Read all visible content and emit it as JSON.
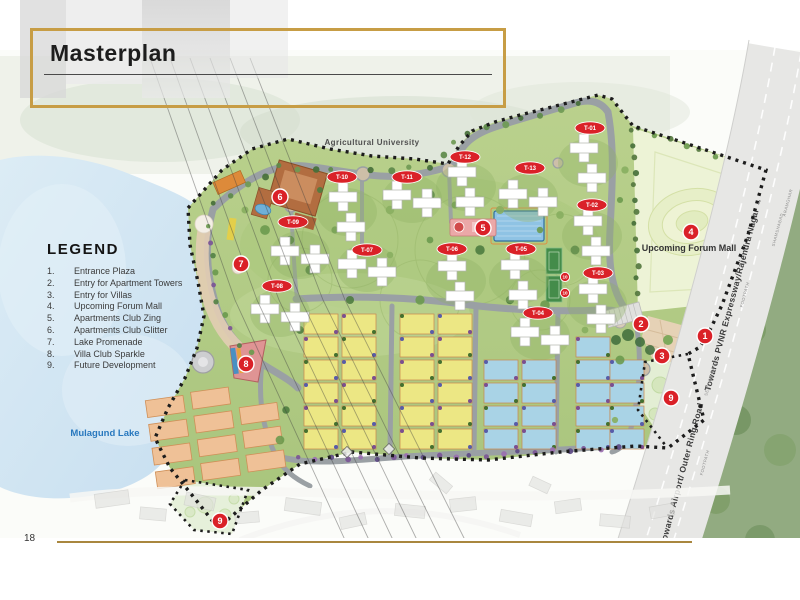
{
  "page": {
    "title": "Masterplan",
    "page_number": "18"
  },
  "legend": {
    "heading": "LEGEND",
    "items": [
      {
        "num": "1.",
        "label": "Entrance Plaza"
      },
      {
        "num": "2.",
        "label": "Entry for Apartment Towers"
      },
      {
        "num": "3.",
        "label": "Entry for Villas"
      },
      {
        "num": "4.",
        "label": "Upcoming Forum Mall"
      },
      {
        "num": "5.",
        "label": "Apartments Club Zing"
      },
      {
        "num": "6.",
        "label": "Apartments Club Glitter"
      },
      {
        "num": "7.",
        "label": "Lake Promenade"
      },
      {
        "num": "8.",
        "label": "Villa Club Sparkle"
      },
      {
        "num": "9.",
        "label": "Future Development"
      }
    ]
  },
  "map": {
    "labels": {
      "university": "Agricultural University",
      "mall": "Upcoming Forum Mall",
      "lake": "Mulagund Lake",
      "road_northeast": "Towards  PVNR Expressway/Rajendra Nagar →",
      "road_southwest": "← Towards Airport/ Outer Ring Road",
      "service_road": "SERVICE ROAD",
      "footpath": "FOOTPATH",
      "shamshabad": "SHAMSHABAD",
      "aramghar": "ARAMGHAR"
    },
    "towers": [
      {
        "id": "T-01",
        "x": 590,
        "y": 128
      },
      {
        "id": "T-02",
        "x": 592,
        "y": 205
      },
      {
        "id": "T-03",
        "x": 598,
        "y": 273
      },
      {
        "id": "T-04",
        "x": 538,
        "y": 313
      },
      {
        "id": "T-05",
        "x": 521,
        "y": 249
      },
      {
        "id": "T-06",
        "x": 452,
        "y": 249
      },
      {
        "id": "T-07",
        "x": 367,
        "y": 250
      },
      {
        "id": "T-08",
        "x": 277,
        "y": 286
      },
      {
        "id": "T-09",
        "x": 293,
        "y": 222
      },
      {
        "id": "T-10",
        "x": 342,
        "y": 177
      },
      {
        "id": "T-11",
        "x": 407,
        "y": 177
      },
      {
        "id": "T-12",
        "x": 465,
        "y": 157
      },
      {
        "id": "T-13",
        "x": 530,
        "y": 168
      }
    ],
    "markers": [
      {
        "num": "1",
        "x": 705,
        "y": 336
      },
      {
        "num": "2",
        "x": 641,
        "y": 324
      },
      {
        "num": "3",
        "x": 662,
        "y": 356
      },
      {
        "num": "4",
        "x": 691,
        "y": 232
      },
      {
        "num": "5",
        "x": 483,
        "y": 228
      },
      {
        "num": "6",
        "x": 280,
        "y": 197
      },
      {
        "num": "7",
        "x": 241,
        "y": 264
      },
      {
        "num": "8",
        "x": 246,
        "y": 364
      },
      {
        "num": "9",
        "x": 671,
        "y": 398
      },
      {
        "num": "9",
        "x": 220,
        "y": 521
      },
      {
        "num": "10",
        "x": 565,
        "y": 277,
        "small": true
      },
      {
        "num": "10",
        "x": 565,
        "y": 293,
        "small": true
      }
    ],
    "colors": {
      "marker_red": "#da2128",
      "gold": "#c79d45",
      "lake_blue": "#cfe3f0"
    }
  }
}
